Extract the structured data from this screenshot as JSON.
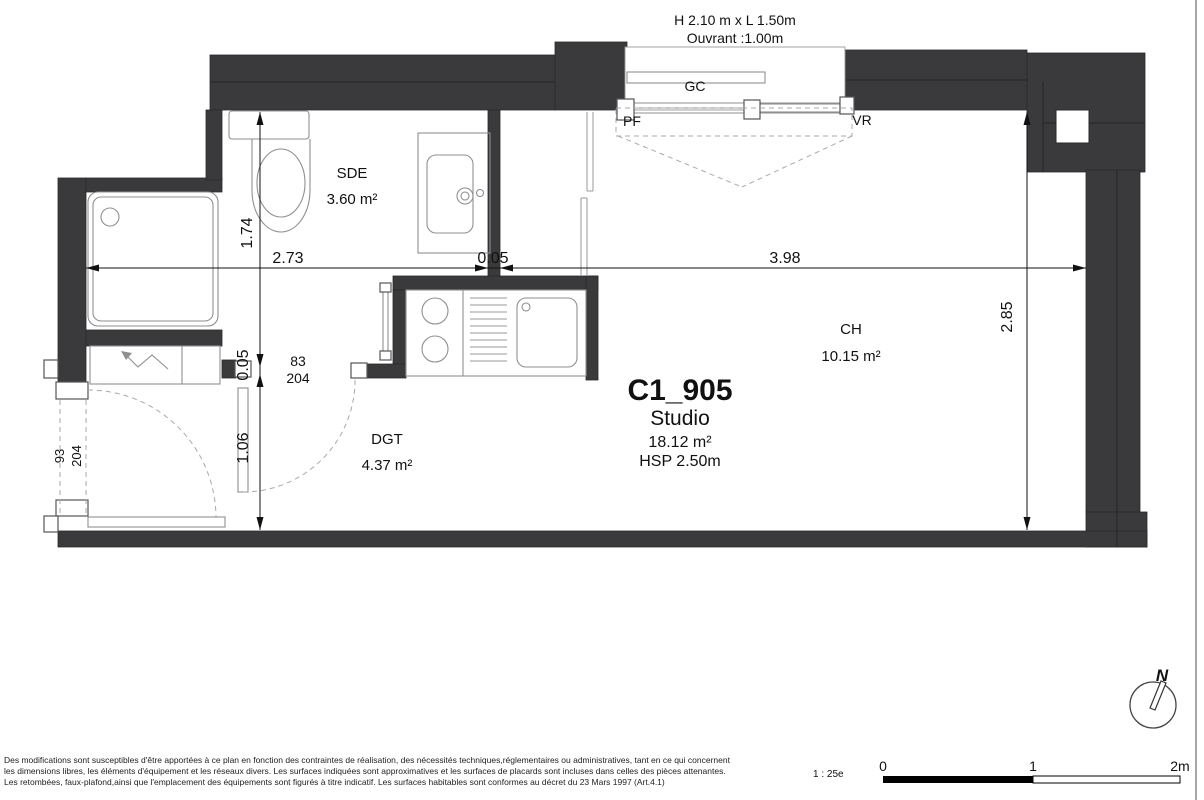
{
  "header": {
    "window_size": "H 2.10 m x  L 1.50m",
    "window_opening": "Ouvrant :1.00m"
  },
  "plan": {
    "unit": {
      "id": "C1_905",
      "type": "Studio",
      "area": "18.12 m²",
      "ceiling_height": "HSP 2.50m"
    },
    "rooms": [
      {
        "name": "SDE",
        "area": "3.60 m²"
      },
      {
        "name": "DGT",
        "area": "4.37 m²"
      },
      {
        "name": "CH",
        "area": "10.15 m²"
      }
    ],
    "tags": {
      "gc": "GC",
      "pf": "PF",
      "vr": "VR"
    },
    "doors": {
      "interior": {
        "width": "83",
        "height": "204"
      },
      "entry": {
        "width": "93",
        "height": "204"
      }
    },
    "dims": {
      "sde_width": "2.73",
      "wall_thickness": "0.05",
      "ch_width": "3.98",
      "sde_depth": "1.74",
      "door_wall": "0.05",
      "dgt_depth": "1.06",
      "ch_depth": "2.85"
    }
  },
  "compass": {
    "north": "N"
  },
  "scale": {
    "ratio": "1 : 25e",
    "tick0": "0",
    "tick1": "1",
    "tick2": "2m"
  },
  "footer": {
    "line1": "Des modifications sont susceptibles d'être apportées à ce plan en fonction des contraintes de réalisation, des nécessités techniques,réglementaires ou administratives, tant en ce qui concernent",
    "line2": "les dimensions libres, les éléments d'équipement et les réseaux divers. Les surfaces indiquées sont approximatives et les surfaces de placards sont incluses dans celles des pièces attenantes.",
    "line3": "Les retombées, faux-plafond,ainsi que l'emplacement des équipements sont figurés à titre indicatif. Les surfaces habitables sont conformes au décret du 23 Mars 1997 (Art.4.1)"
  },
  "colors": {
    "wall": "#3a3a3c",
    "background": "#ffffff"
  }
}
